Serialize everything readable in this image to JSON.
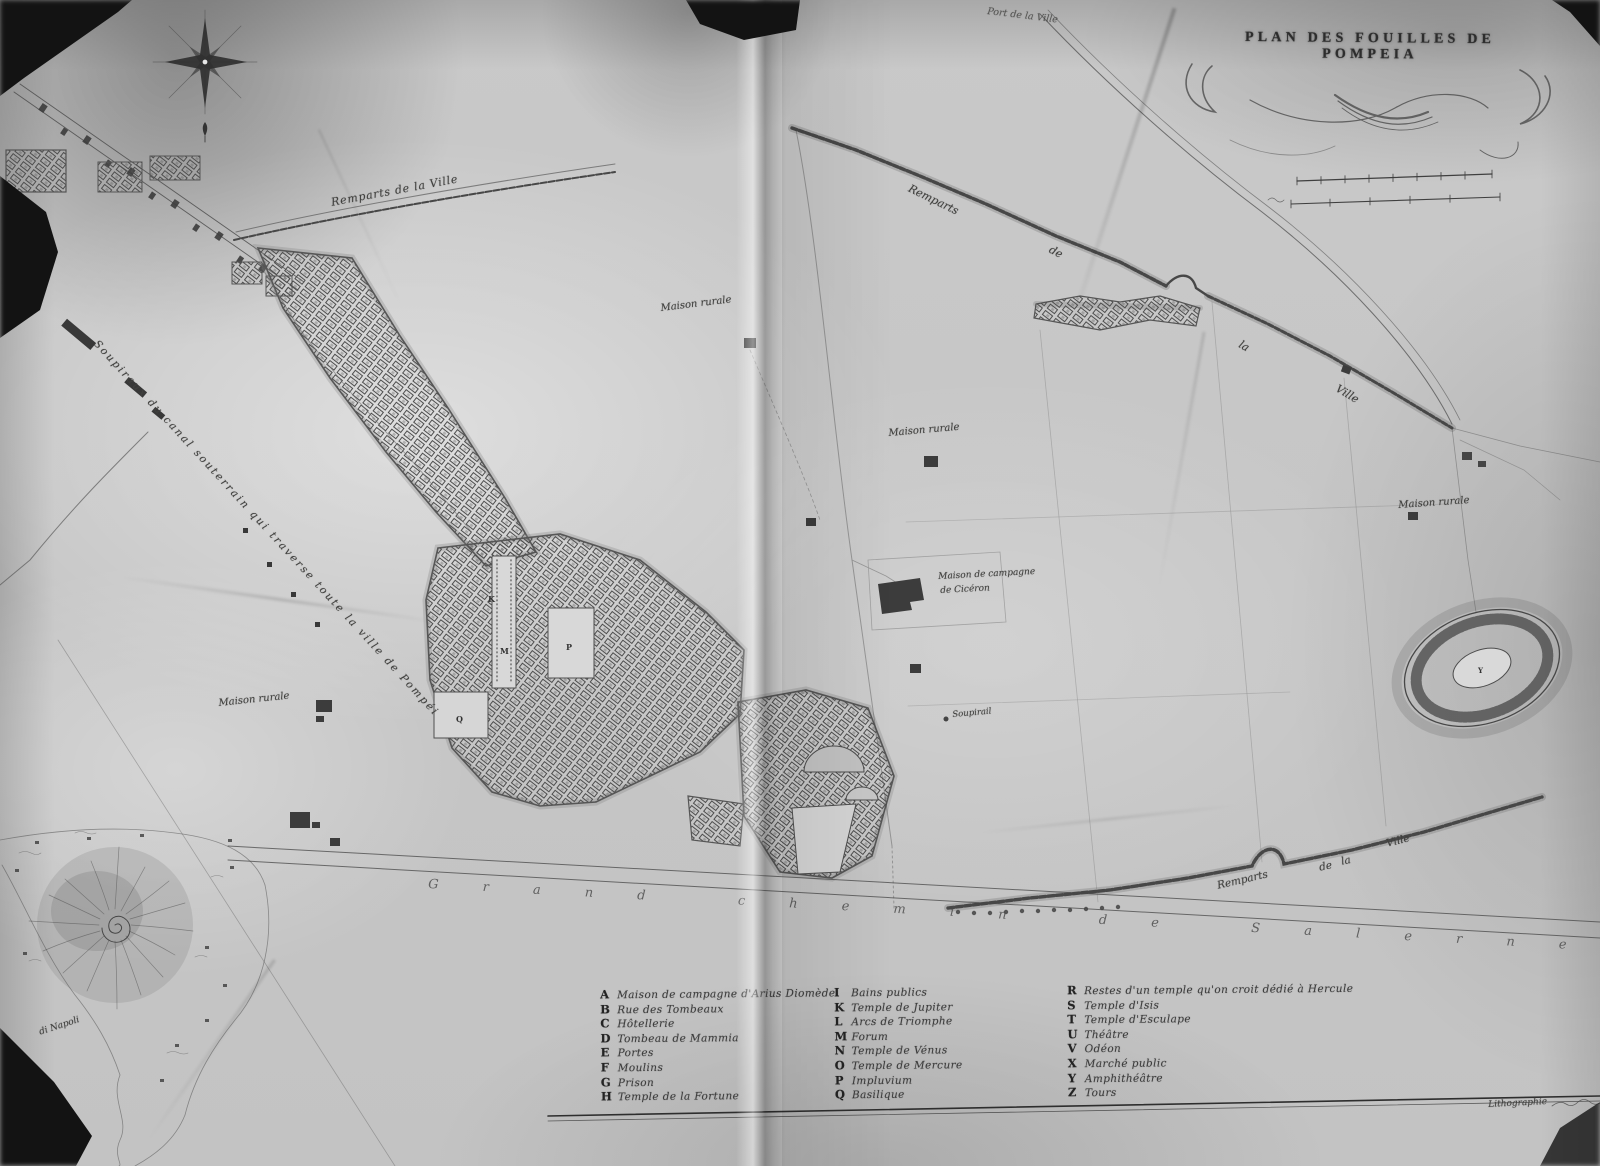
{
  "title": "PLAN DES FOUILLES DE POMPEIA",
  "labels": {
    "port_ville": "Port de la Ville",
    "remparts_ville": "Remparts de la Ville",
    "rem_ne1": "Remparts",
    "rem_ne2": "de",
    "rem_ne3": "la",
    "rem_ne4": "Ville",
    "rem_s1": "Remparts",
    "rem_s2": "de",
    "rem_s3": "la",
    "rem_s4": "Ville",
    "maison_rurale": "Maison rurale",
    "ciceron_l1": "Maison de campagne",
    "ciceron_l2": "de Cicéron",
    "soupirail": "Soupirail",
    "canal": "Soupiraux du canal souterrain qui traverse toute la ville de Pompéi",
    "grand_chemin": "Grand chemin de Salerne",
    "napoli": "di Napoli",
    "credit": "Lithographie"
  },
  "plan_letters": {
    "K": "K",
    "M": "M",
    "P": "P",
    "Q": "Q",
    "Y": "Y"
  },
  "legend": {
    "col1": [
      {
        "k": "A",
        "t": "Maison de campagne d'Arius Diomède"
      },
      {
        "k": "B",
        "t": "Rue des Tombeaux"
      },
      {
        "k": "C",
        "t": "Hôtellerie"
      },
      {
        "k": "D",
        "t": "Tombeau de Mammia"
      },
      {
        "k": "E",
        "t": "Portes"
      },
      {
        "k": "F",
        "t": "Moulins"
      },
      {
        "k": "G",
        "t": "Prison"
      },
      {
        "k": "H",
        "t": "Temple de la Fortune"
      }
    ],
    "col2": [
      {
        "k": "I",
        "t": "Bains publics"
      },
      {
        "k": "K",
        "t": "Temple de Jupiter"
      },
      {
        "k": "L",
        "t": "Arcs de Triomphe"
      },
      {
        "k": "M",
        "t": "Forum"
      },
      {
        "k": "N",
        "t": "Temple de Vénus"
      },
      {
        "k": "O",
        "t": "Temple de Mercure"
      },
      {
        "k": "P",
        "t": "Impluvium"
      },
      {
        "k": "Q",
        "t": "Basilique"
      }
    ],
    "col3": [
      {
        "k": "R",
        "t": "Restes d'un temple qu'on croit dédié à Hercule"
      },
      {
        "k": "S",
        "t": "Temple d'Isis"
      },
      {
        "k": "T",
        "t": "Temple d'Esculape"
      },
      {
        "k": "U",
        "t": "Théâtre"
      },
      {
        "k": "V",
        "t": "Odéon"
      },
      {
        "k": "X",
        "t": "Marché public"
      },
      {
        "k": "Y",
        "t": "Amphithéâtre"
      },
      {
        "k": "Z",
        "t": "Tours"
      }
    ]
  },
  "colors": {
    "photo_bg": "#141414",
    "paper": "#c6c6c6",
    "ink": "#3f3f3f"
  }
}
